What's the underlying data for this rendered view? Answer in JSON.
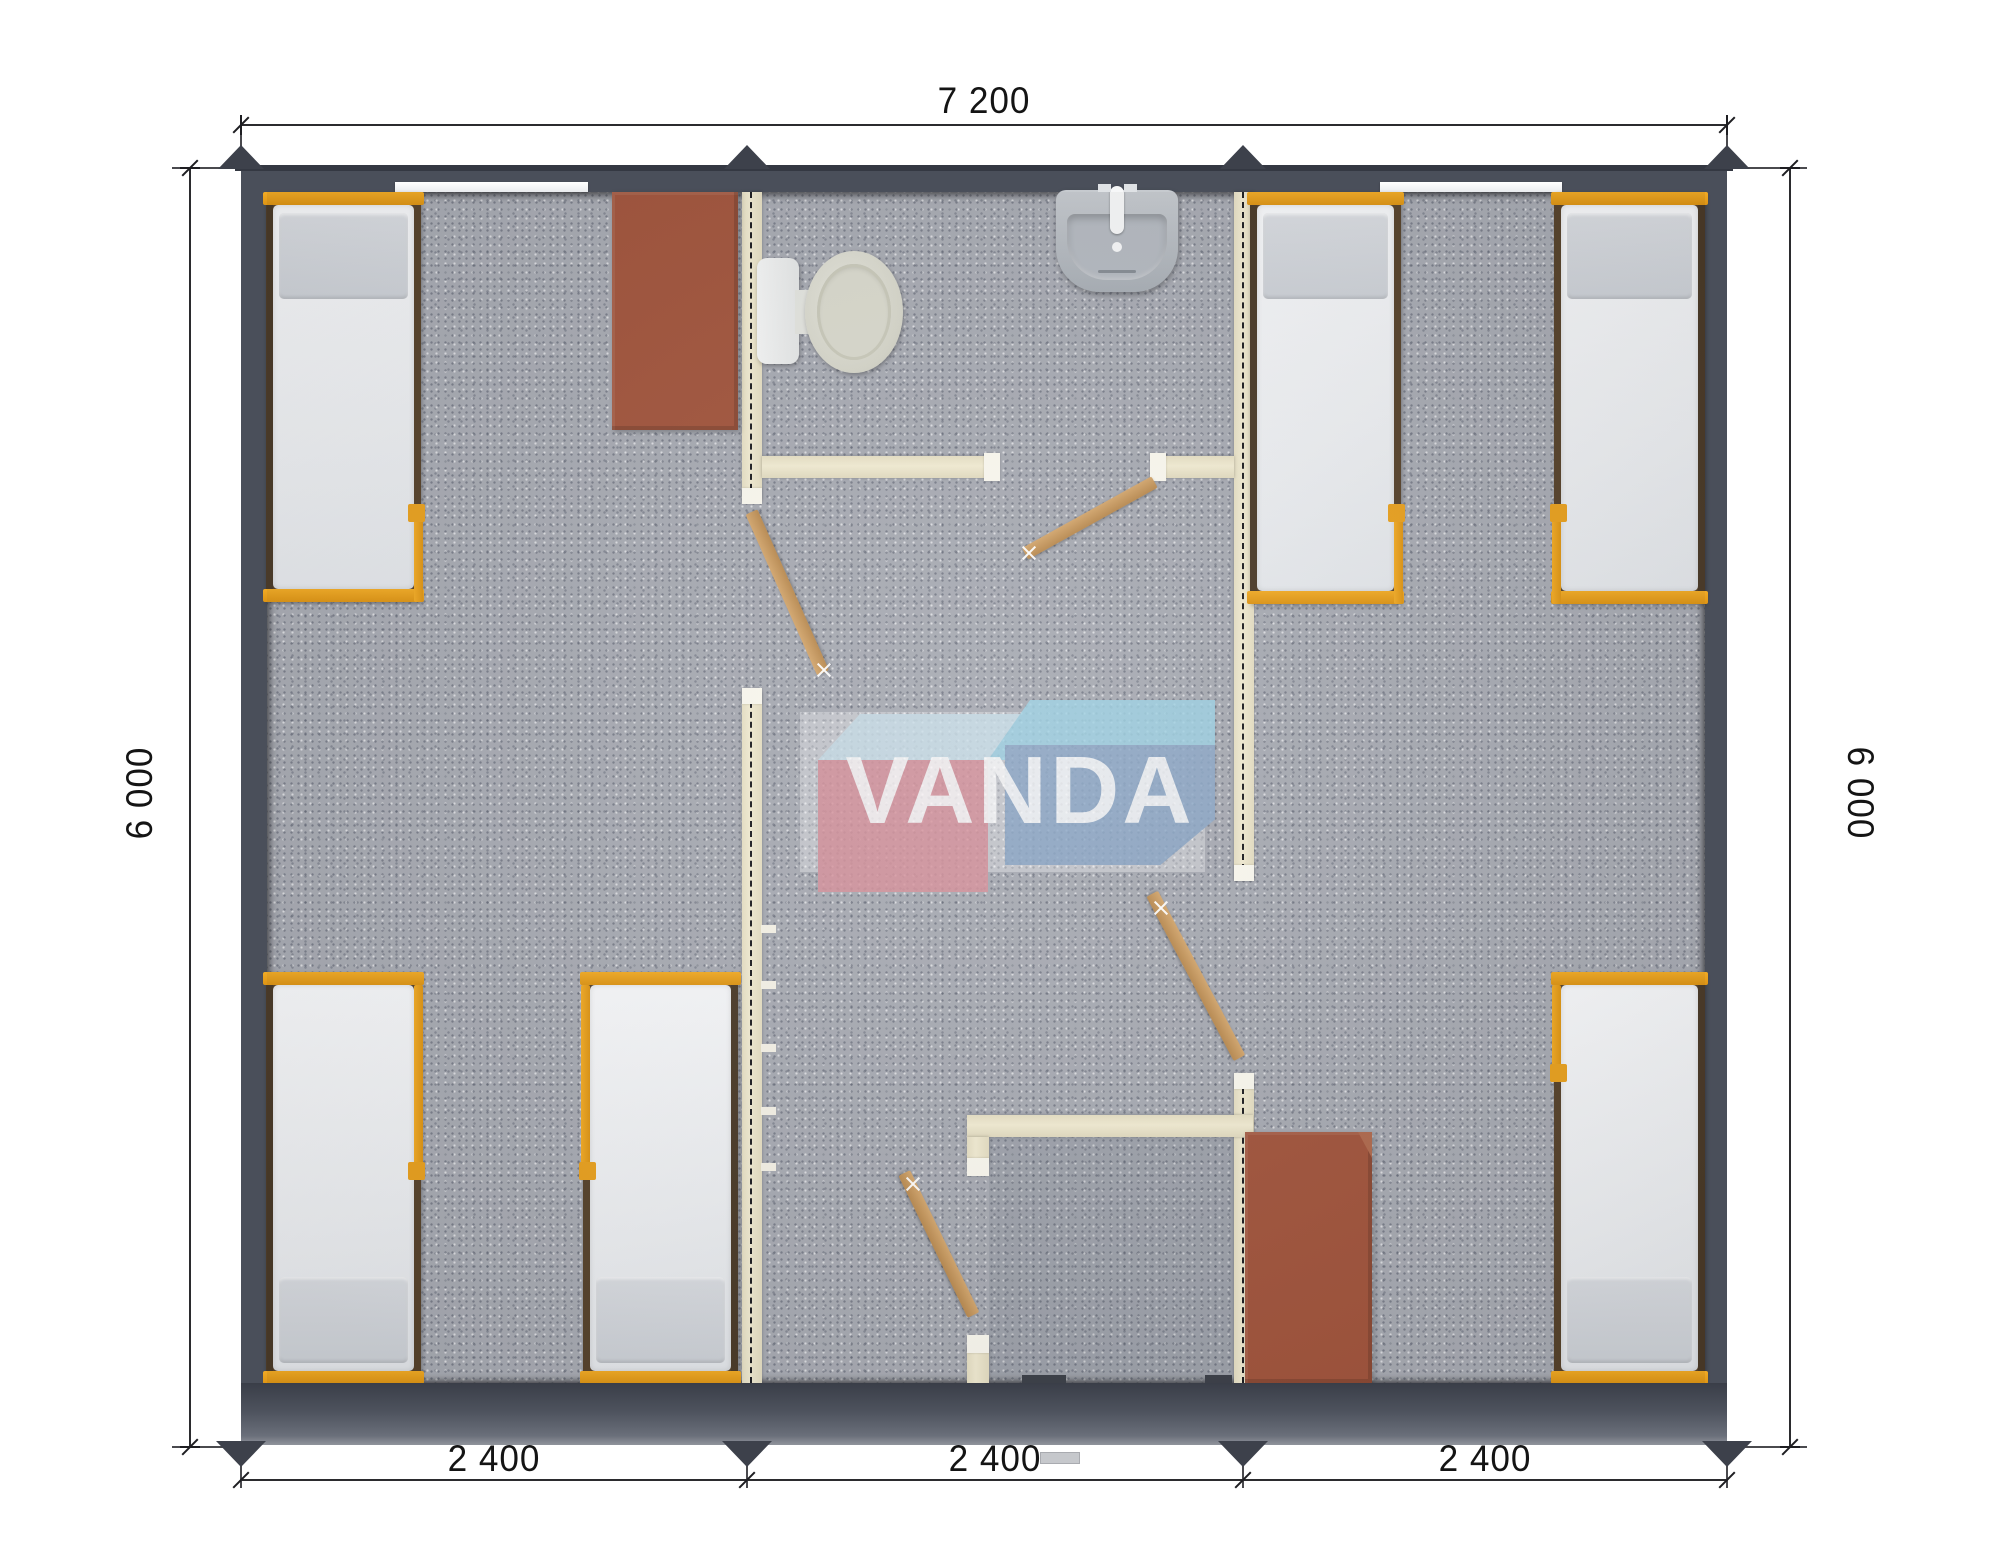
{
  "dimensions": {
    "width_total": "7 200",
    "height_left": "6 000",
    "height_right": "6 000",
    "modules": [
      "2 400",
      "2 400",
      "2 400"
    ]
  },
  "logo": {
    "text": "VANDA",
    "colors": {
      "pink_box": "#d8919b",
      "blue_box": "#8ca8c8",
      "light_blue_top": "#9ed2e4",
      "text": "#ffffff"
    }
  },
  "fixtures": {
    "beds": 6,
    "wardrobes": 2,
    "toilets": 1,
    "sinks": 1,
    "interior_doors": 4,
    "rooms": [
      "bedroom-left",
      "bathroom",
      "hallway",
      "shower-room",
      "bedroom-right"
    ]
  },
  "palette": {
    "outer_wall": "#4a4f5a",
    "floor": "#a8abb3",
    "partition": "#ece5cb",
    "bed_frame": "#e9a11f",
    "wardrobe": "#a2553d",
    "door_wood": "#c89a62"
  }
}
